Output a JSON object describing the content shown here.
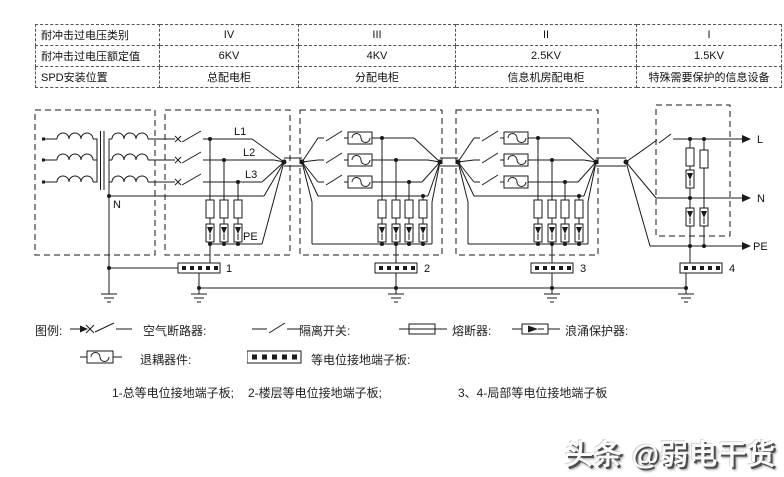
{
  "table": {
    "rows": [
      {
        "label": "耐冲击过电压类别",
        "values": [
          "IV",
          "III",
          "II",
          "I"
        ]
      },
      {
        "label": "耐冲击过电压额定值",
        "values": [
          "6KV",
          "4KV",
          "2.5KV",
          "1.5KV"
        ]
      },
      {
        "label": "SPD安装位置",
        "values": [
          "总配电柜",
          "分配电柜",
          "信息机房配电柜",
          "特殊需要保护的信息设备"
        ]
      }
    ]
  },
  "diagram": {
    "conductor_labels": {
      "l1": "L1",
      "l2": "L2",
      "l3": "L3",
      "n": "N",
      "pe": "PE"
    },
    "output_labels": {
      "l": "L",
      "n": "N",
      "pe": "PE"
    },
    "terminal_boards": [
      "1",
      "2",
      "3",
      "4"
    ]
  },
  "legend": {
    "title": "图例:",
    "breaker": "空气断路器:",
    "isolator": "隔离开关:",
    "fuse": "熔断器:",
    "spd": "浪涌保护器:",
    "decoupler": "退耦器件:",
    "board": "等电位接地端子板:",
    "note1": "1-总等电位接地端子板;",
    "note2": "2-楼层等电位接地端子板;",
    "note3": "3、4-局部等电位接地端子板"
  },
  "watermark": "头条 @弱电干货",
  "colors": {
    "ink": "#1a1a1a",
    "paper": "#ffffff"
  }
}
